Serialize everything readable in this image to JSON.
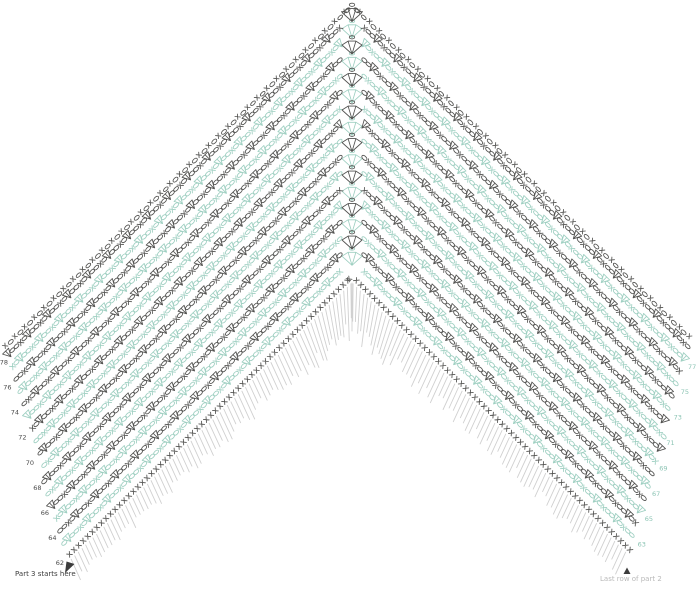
{
  "labels": {
    "part3_start": "Part 3 starts here",
    "last_row_part2": "Last row of part 2"
  },
  "colors": {
    "teal_row": "#9ecfc1",
    "dark_row": "#525250",
    "teal_number": "#8cc4b4",
    "dark_number": "#4a4a4a",
    "previous_row_gray": "#d0d0d0",
    "label_dark": "#3c3c3c",
    "label_faded": "#b9b9b9",
    "background": "#ffffff"
  },
  "diagram": {
    "type": "crochet-chevron-chart",
    "symbols": {
      "x": "single-crochet-icon",
      "oval": "chain-stitch-icon",
      "triangle": "cluster-stitch-icon",
      "fan": "peak-shell-icon",
      "gray_hatch": "previous-part-stitches"
    },
    "edging_row": {
      "style": "x-o",
      "color": "dark"
    },
    "rows": [
      {
        "number": 62,
        "side": "left",
        "color": "dark",
        "style": "sc-row"
      },
      {
        "number": 63,
        "side": "right",
        "color": "teal",
        "style": "pattern"
      },
      {
        "number": 64,
        "side": "left",
        "color": "dark",
        "style": "pattern"
      },
      {
        "number": 65,
        "side": "right",
        "color": "teal",
        "style": "pattern"
      },
      {
        "number": 66,
        "side": "left",
        "color": "dark",
        "style": "pattern"
      },
      {
        "number": 67,
        "side": "right",
        "color": "teal",
        "style": "pattern"
      },
      {
        "number": 68,
        "side": "left",
        "color": "dark",
        "style": "pattern"
      },
      {
        "number": 69,
        "side": "right",
        "color": "teal",
        "style": "pattern"
      },
      {
        "number": 70,
        "side": "left",
        "color": "dark",
        "style": "pattern"
      },
      {
        "number": 71,
        "side": "right",
        "color": "teal",
        "style": "pattern"
      },
      {
        "number": 72,
        "side": "left",
        "color": "dark",
        "style": "pattern"
      },
      {
        "number": 73,
        "side": "right",
        "color": "teal",
        "style": "pattern"
      },
      {
        "number": 74,
        "side": "left",
        "color": "dark",
        "style": "pattern"
      },
      {
        "number": 75,
        "side": "right",
        "color": "teal",
        "style": "pattern"
      },
      {
        "number": 76,
        "side": "left",
        "color": "dark",
        "style": "pattern"
      },
      {
        "number": 77,
        "side": "right",
        "color": "teal",
        "style": "pattern"
      },
      {
        "number": 78,
        "side": "left",
        "color": "dark",
        "style": "pattern"
      }
    ]
  }
}
